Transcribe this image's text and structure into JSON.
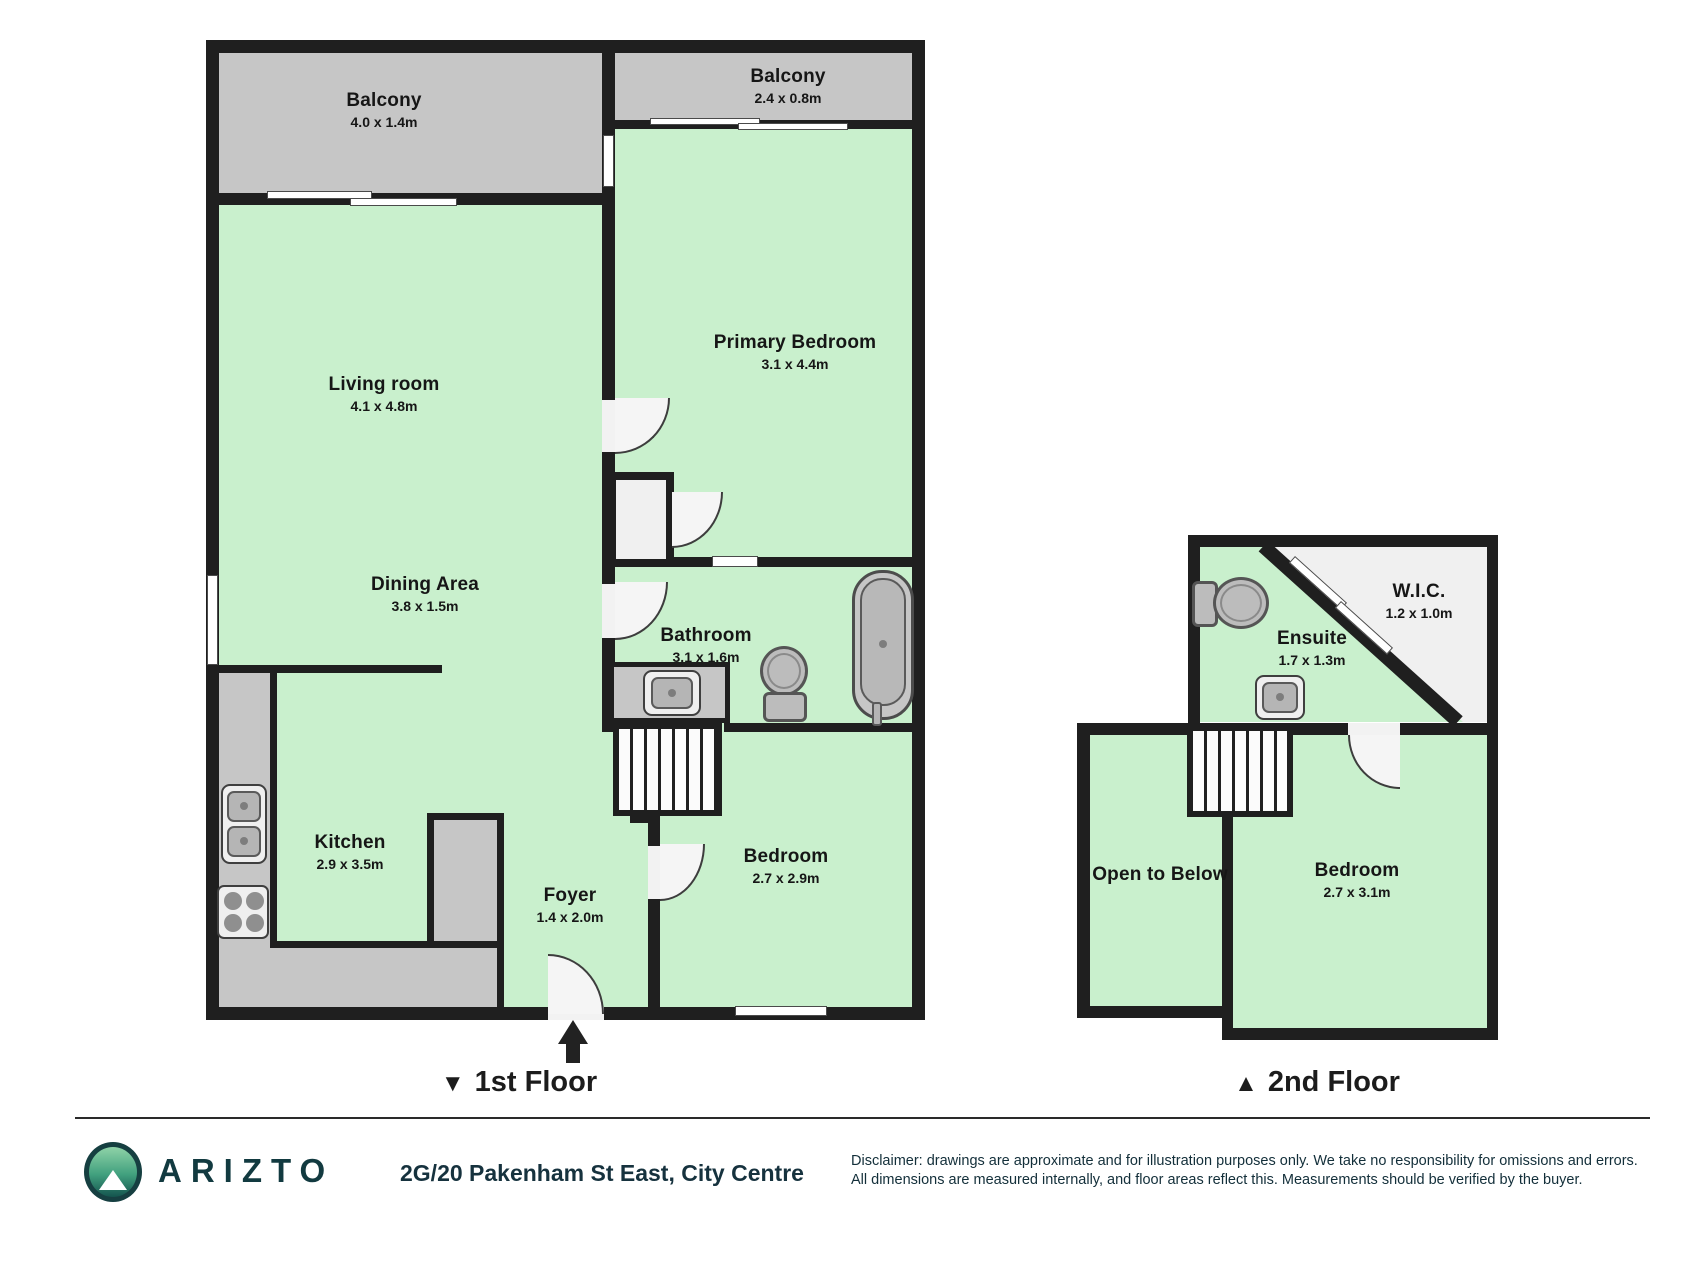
{
  "first_floor": {
    "caption": {
      "marker": "▼",
      "label": "1st Floor"
    },
    "rooms": {
      "balcony_left": {
        "name": "Balcony",
        "dims": "4.0 x 1.4m"
      },
      "balcony_right": {
        "name": "Balcony",
        "dims": "2.4 x 0.8m"
      },
      "living": {
        "name": "Living room",
        "dims": "4.1 x 4.8m"
      },
      "dining": {
        "name": "Dining Area",
        "dims": "3.8 x 1.5m"
      },
      "primary_bedroom": {
        "name": "Primary Bedroom",
        "dims": "3.1 x 4.4m"
      },
      "bathroom": {
        "name": "Bathroom",
        "dims": "3.1 x 1.6m"
      },
      "kitchen": {
        "name": "Kitchen",
        "dims": "2.9 x 3.5m"
      },
      "foyer": {
        "name": "Foyer",
        "dims": "1.4 x 2.0m"
      },
      "bedroom": {
        "name": "Bedroom",
        "dims": "2.7 x 2.9m"
      }
    }
  },
  "second_floor": {
    "caption": {
      "marker": "▲",
      "label": "2nd Floor"
    },
    "rooms": {
      "wic": {
        "name": "W.I.C.",
        "dims": "1.2 x 1.0m"
      },
      "ensuite": {
        "name": "Ensuite",
        "dims": "1.7 x 1.3m"
      },
      "open_to_below": {
        "name": "Open to Below"
      },
      "bedroom": {
        "name": "Bedroom",
        "dims": "2.7 x 3.1m"
      }
    }
  },
  "footer": {
    "brand": "ARIZTO",
    "address": "2G/20 Pakenham St East, City Centre",
    "disclaimer_line1": "Disclaimer: drawings are approximate and for illustration purposes only. We take no responsibility for omissions and errors.",
    "disclaimer_line2": "All dimensions are measured internally, and floor areas reflect this. Measurements should be verified by the buyer."
  },
  "colors": {
    "room_fill": "#c9f0cd",
    "balcony_fill": "#c6c6c6",
    "wall": "#1f1f1f",
    "brand_teal": "#123a40"
  }
}
